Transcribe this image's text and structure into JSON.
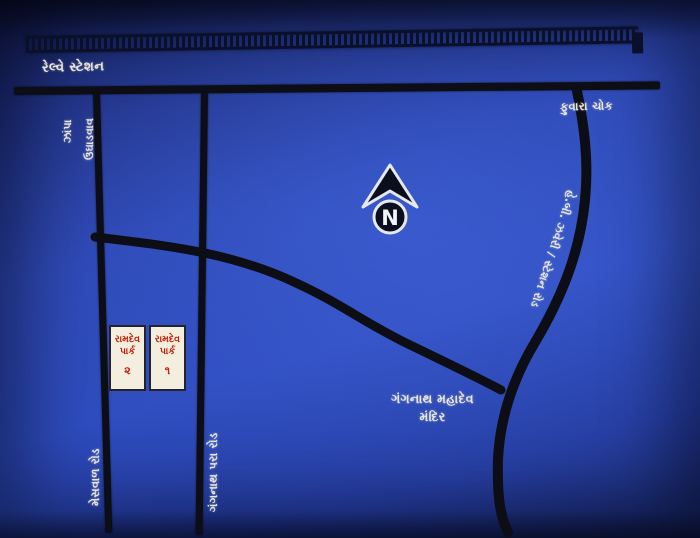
{
  "map": {
    "title_area": {
      "railway_station_label": "રેલ્વે સ્ટેશન",
      "fuvara_chowk_label": "ફુવારા ચોક"
    },
    "north_symbol": {
      "letter": "N"
    },
    "road_labels": {
      "top_left_part1": "ઉઘાડવાવ",
      "top_left_part2": "ઝાંપા",
      "bottom_left_road": "મેસવાળ રોડ",
      "middle_road": "ગંગનાથ પરા રોડ",
      "right_road": "હે.બી. ઝવેરી / સ્ટેશન રોડ"
    },
    "temple": {
      "line1": "ગંગનાથ મહાદેવ",
      "line2": "મંદિર"
    },
    "parks": [
      {
        "line1": "રામદેવ",
        "line2": "પાર્ક",
        "number": "૨"
      },
      {
        "line1": "રામદેવ",
        "line2": "પાર્ક",
        "number": "૧"
      }
    ],
    "colors": {
      "background_blue": "#2a43ae",
      "road_black": "#0c0d15",
      "label_white": "#e9e6da",
      "park_text_red": "#c21f0c",
      "park_box_bg": "#f3eedd"
    }
  }
}
